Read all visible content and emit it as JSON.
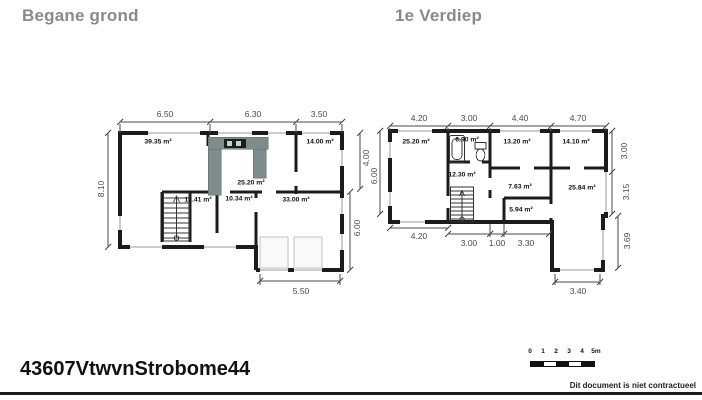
{
  "header": {
    "ground_title": "Begane grond",
    "first_title": "1e Verdiep"
  },
  "plans": {
    "ground": {
      "dims_top": [
        "6.50",
        "6.30",
        "3.50"
      ],
      "dim_left": "8.10",
      "dim_right_top": "4.00",
      "dim_right_bottom": "6.00",
      "dim_bottom": "5.50",
      "rooms": [
        "39.35 m²",
        "14.00 m²",
        "25.20 m²",
        "12.41 m²",
        "10.34 m²",
        "33.00 m²"
      ]
    },
    "first": {
      "dims_top": [
        "4.20",
        "3.00",
        "4.40",
        "4.70"
      ],
      "dim_left": "6.00",
      "dims_right": [
        "3.00",
        "3.15",
        "3.69"
      ],
      "dims_bottom": [
        "4.20",
        "3.00",
        "1.00",
        "3.30"
      ],
      "dim_bottom_ext": "3.40",
      "rooms": [
        "25.20 m²",
        "6.90 m²",
        "12.30 m²",
        "13.20 m²",
        "14.10 m²",
        "7.63 m²",
        "5.94 m²",
        "25.84 m²"
      ]
    }
  },
  "footer": {
    "reference": "43607VtwvnStrobome44",
    "disclaimer": "Dit document is niet contractueel",
    "scale": {
      "labels": [
        "0",
        "1",
        "2",
        "3",
        "4",
        "5m"
      ]
    }
  },
  "colors": {
    "wall": "#1c1c1c",
    "dimension": "#4a4a4a",
    "counter": "#7e8d8c",
    "title_gray": "#8a8a8a",
    "light_outline": "#c2c2c2"
  }
}
